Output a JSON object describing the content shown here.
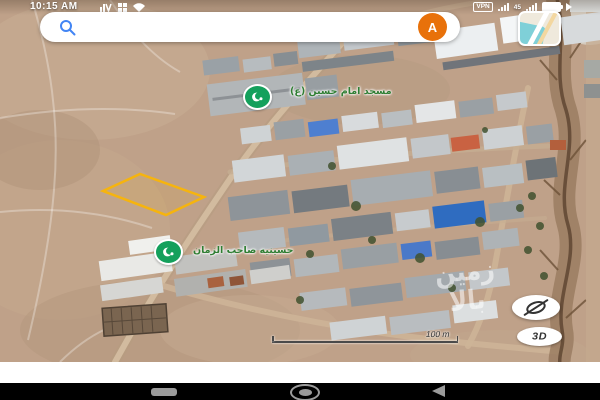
{
  "status_bar": {
    "time": "10:15 AM",
    "vpn_label": "VPN",
    "sim_indicator": "45",
    "icons": [
      "volte-icon",
      "apps-grid-icon",
      "wifi-icon",
      "signal-bars-icon",
      "battery-icon",
      "arrow-icon"
    ]
  },
  "search": {
    "query": "سیاهسنگ",
    "avatar_letter": "A",
    "icons": [
      "search-icon",
      "avatar",
      "map-style-thumbnail"
    ]
  },
  "map": {
    "pois": [
      {
        "label": "مسجد امام حسین (ع)",
        "icon": "mosque-icon"
      },
      {
        "label": "حسینیه صاحب الزمان",
        "icon": "mosque-icon"
      }
    ],
    "watermark_line1": "زمین",
    "watermark_line2": "بالا",
    "scale_label": "100 m",
    "three_d_label": "3D",
    "buttons": [
      "compass-button",
      "3d-button"
    ]
  },
  "colors": {
    "avatar_bg": "#e8710a",
    "poi_green": "#14a05c",
    "poi_label_green": "#2e7d32",
    "parcel_stroke": "#f6b40e",
    "search_icon_blue": "#4285f4"
  }
}
